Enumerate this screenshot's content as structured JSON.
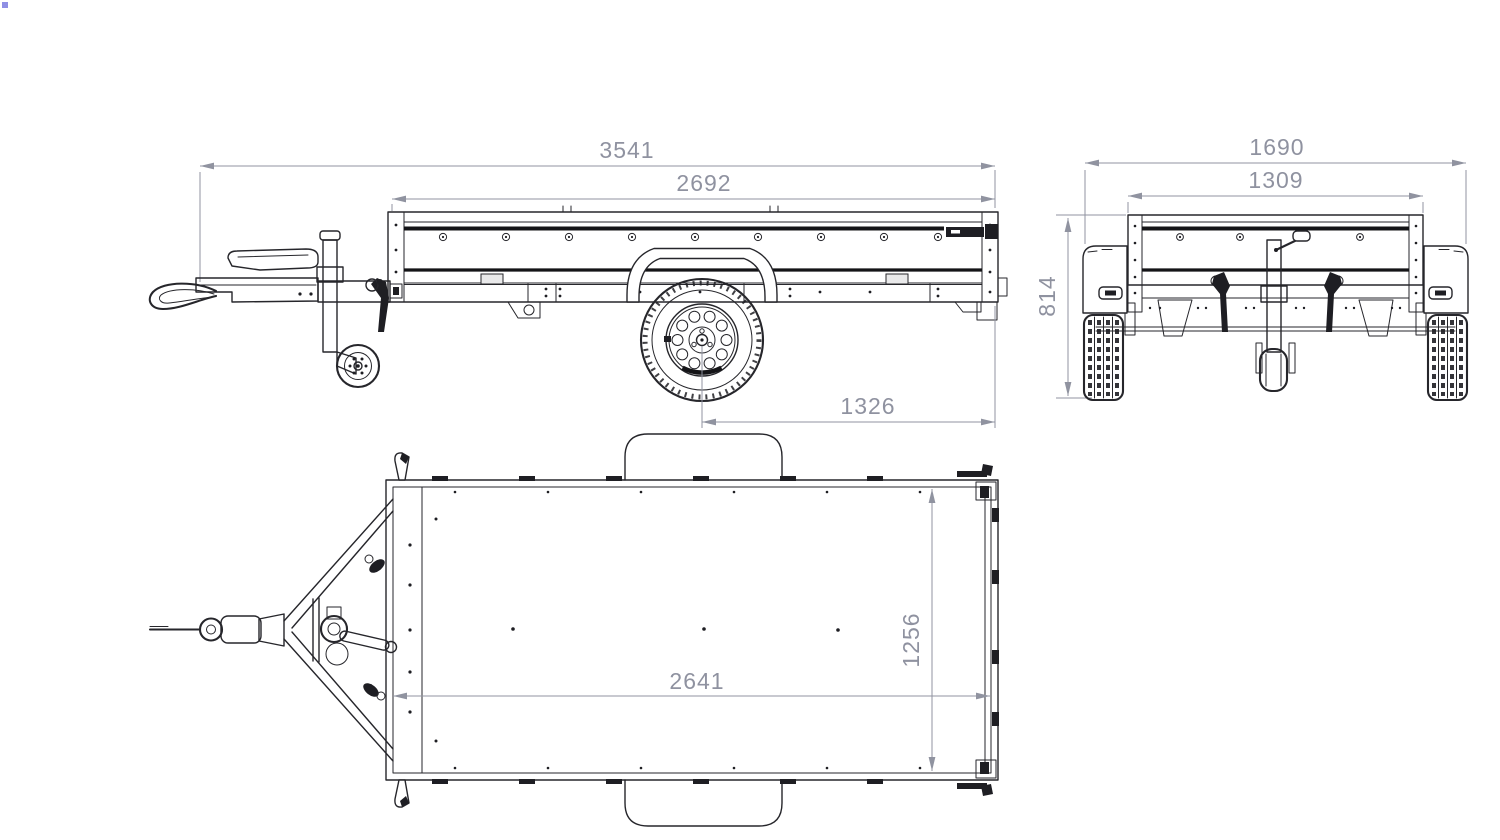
{
  "colors": {
    "background": "#ffffff",
    "line": "#26262b",
    "line_heavy": "#141417",
    "dimension": "#9093a0",
    "cursor_artifact": "#7b7bdf"
  },
  "dimensions": {
    "side": {
      "overall_length": "3541",
      "bed_length": "2692",
      "axle_to_rear": "1326"
    },
    "rear": {
      "overall_width": "1690",
      "bed_width": "1309",
      "bed_height": "814"
    },
    "top": {
      "bed_inner_length": "2641",
      "bed_inner_width": "1256"
    }
  }
}
